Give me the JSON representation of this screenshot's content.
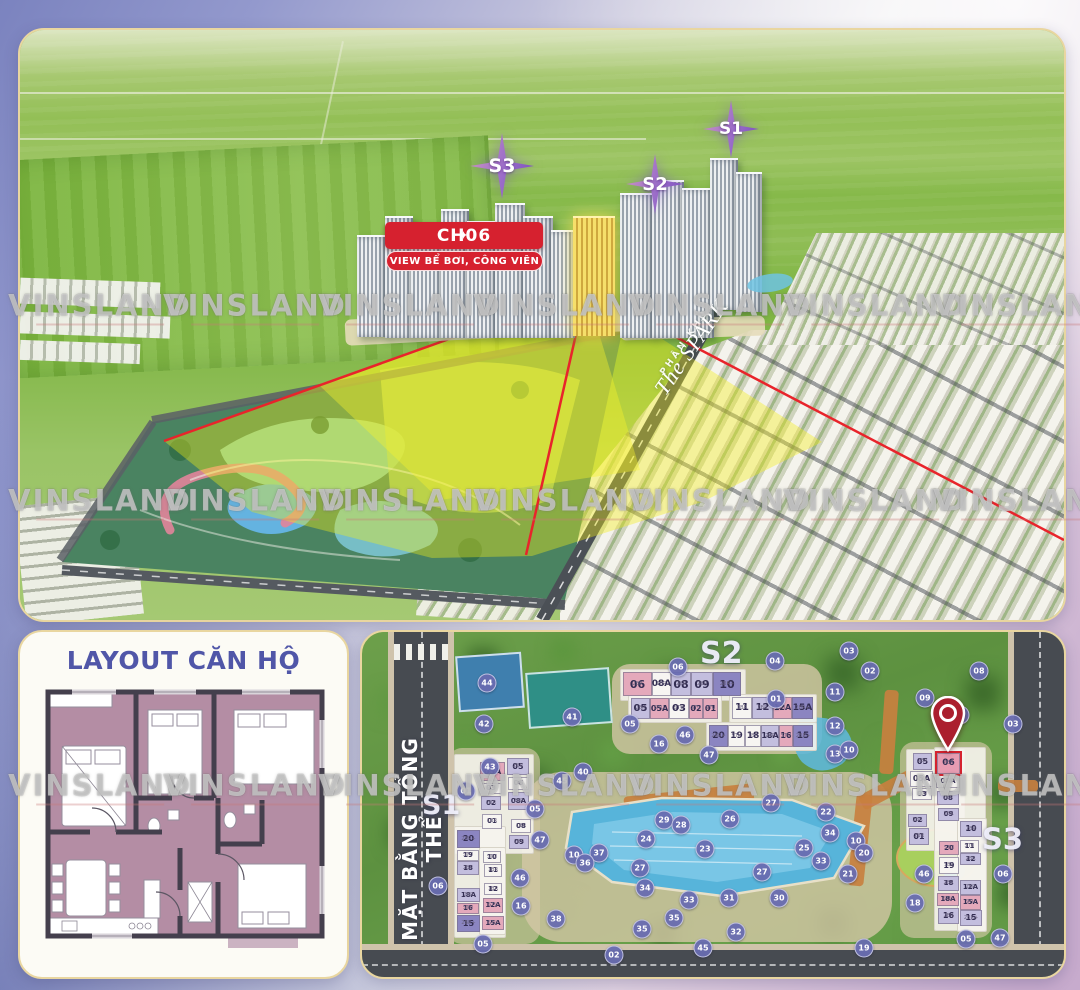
{
  "brand": {
    "watermark": "VINSLAND"
  },
  "colors": {
    "accent_red": "#d6212f",
    "star_purple": "#8e63c6",
    "marker_purple": "#686cb0",
    "tone_pink": "#e4a9bb",
    "tone_light": "#c3bede",
    "tone_dark": "#8b85c1",
    "gold_highlight": "#f6df6a"
  },
  "watermarks": [
    {
      "x": 100,
      "y": 307
    },
    {
      "x": 255,
      "y": 307
    },
    {
      "x": 410,
      "y": 307
    },
    {
      "x": 565,
      "y": 307
    },
    {
      "x": 720,
      "y": 307
    },
    {
      "x": 875,
      "y": 307
    },
    {
      "x": 1025,
      "y": 307
    },
    {
      "x": 100,
      "y": 502
    },
    {
      "x": 255,
      "y": 502
    },
    {
      "x": 410,
      "y": 502
    },
    {
      "x": 565,
      "y": 502
    },
    {
      "x": 720,
      "y": 502
    },
    {
      "x": 875,
      "y": 502
    },
    {
      "x": 1025,
      "y": 502
    },
    {
      "x": 100,
      "y": 787
    },
    {
      "x": 255,
      "y": 787
    },
    {
      "x": 410,
      "y": 787
    },
    {
      "x": 565,
      "y": 787
    },
    {
      "x": 720,
      "y": 787
    },
    {
      "x": 875,
      "y": 787
    },
    {
      "x": 1025,
      "y": 787
    }
  ],
  "aerial": {
    "badges": [
      {
        "label": "S3",
        "x": 450,
        "y": 103,
        "w": 64,
        "h": 66,
        "size": 19
      },
      {
        "label": "S2",
        "x": 606,
        "y": 124,
        "w": 58,
        "h": 60,
        "size": 18
      },
      {
        "label": "S1",
        "x": 683,
        "y": 70,
        "w": 56,
        "h": 58,
        "size": 17
      }
    ],
    "callout": {
      "sparkle": "✦",
      "title": "CH06",
      "subtitle": "VIEW BỂ BƠI, CÔNG VIÊN"
    },
    "zone": {
      "line1": "PHÂN KHU",
      "line2": "The SPARK"
    }
  },
  "floorplan": {
    "title": "LAYOUT CĂN HỘ"
  },
  "siteplan": {
    "side_label": "MẶT BẰNG TỔNG THỂ",
    "labels": [
      {
        "label": "S2",
        "x": 338,
        "y": 4,
        "size": 30
      },
      {
        "label": "S1",
        "x": 60,
        "y": 158,
        "size": 27
      },
      {
        "label": "S3",
        "x": 620,
        "y": 190,
        "size": 29
      }
    ],
    "highlight_unit": "06",
    "cells": [
      {
        "label": "06",
        "sub": "2BR",
        "tone": "pink",
        "x": 261,
        "y": 40,
        "w": 29,
        "h": 24,
        "size": 11
      },
      {
        "label": "08A",
        "sub": "1BR",
        "tone": "white",
        "x": 290,
        "y": 40,
        "w": 19,
        "h": 24,
        "size": 9
      },
      {
        "label": "08",
        "sub": "2BR",
        "tone": "light",
        "x": 309,
        "y": 40,
        "w": 20,
        "h": 24,
        "size": 11
      },
      {
        "label": "09",
        "sub": "2BR",
        "tone": "light",
        "x": 329,
        "y": 40,
        "w": 22,
        "h": 24,
        "size": 11
      },
      {
        "label": "10",
        "sub": "2BR+",
        "tone": "dark",
        "x": 351,
        "y": 40,
        "w": 28,
        "h": 24,
        "size": 11
      },
      {
        "label": "05",
        "sub": "2BR",
        "tone": "light",
        "x": 269,
        "y": 66,
        "w": 19,
        "h": 21,
        "size": 10
      },
      {
        "label": "05A",
        "sub": "STU",
        "tone": "pink",
        "x": 288,
        "y": 66,
        "w": 19,
        "h": 21,
        "size": 8
      },
      {
        "label": "03",
        "sub": "STU",
        "tone": "white",
        "x": 307,
        "y": 66,
        "w": 20,
        "h": 21,
        "size": 10
      },
      {
        "label": "02",
        "sub": "STU",
        "tone": "pink",
        "x": 327,
        "y": 66,
        "w": 14,
        "h": 21,
        "size": 8
      },
      {
        "label": "01",
        "sub": "STU",
        "tone": "pink",
        "x": 341,
        "y": 66,
        "w": 15,
        "h": 21,
        "size": 8
      },
      {
        "label": "11",
        "sub": "1BR",
        "tone": "white",
        "x": 370,
        "y": 65,
        "w": 20,
        "h": 22,
        "size": 10
      },
      {
        "label": "12",
        "sub": "2BR",
        "tone": "light",
        "x": 390,
        "y": 65,
        "w": 21,
        "h": 22,
        "size": 10
      },
      {
        "label": "12A",
        "sub": "STU",
        "tone": "pink",
        "x": 411,
        "y": 65,
        "w": 19,
        "h": 22,
        "size": 8
      },
      {
        "label": "15A",
        "sub": "2BR+",
        "tone": "dark",
        "x": 430,
        "y": 65,
        "w": 21,
        "h": 22,
        "size": 9
      },
      {
        "label": "20",
        "sub": "2BR+",
        "tone": "dark",
        "x": 347,
        "y": 93,
        "w": 19,
        "h": 22,
        "size": 9
      },
      {
        "label": "19",
        "sub": "STU",
        "tone": "white",
        "x": 366,
        "y": 93,
        "w": 17,
        "h": 22,
        "size": 9
      },
      {
        "label": "18",
        "sub": "1BR",
        "tone": "white",
        "x": 383,
        "y": 93,
        "w": 16,
        "h": 22,
        "size": 9
      },
      {
        "label": "18A",
        "sub": "2BR",
        "tone": "light",
        "x": 399,
        "y": 93,
        "w": 18,
        "h": 22,
        "size": 8
      },
      {
        "label": "16",
        "sub": "STU",
        "tone": "pink",
        "x": 417,
        "y": 93,
        "w": 14,
        "h": 22,
        "size": 8
      },
      {
        "label": "15",
        "sub": "2BR+",
        "tone": "dark",
        "x": 431,
        "y": 93,
        "w": 20,
        "h": 22,
        "size": 9
      },
      {
        "label": "05A",
        "sub": "STU",
        "tone": "pink",
        "x": 118,
        "y": 130,
        "w": 25,
        "h": 19,
        "size": 8
      },
      {
        "label": "03",
        "sub": "STU",
        "tone": "white",
        "x": 118,
        "y": 151,
        "w": 22,
        "h": 11,
        "size": 7
      },
      {
        "label": "02",
        "sub": "2BR",
        "tone": "light",
        "x": 119,
        "y": 164,
        "w": 20,
        "h": 14,
        "size": 7
      },
      {
        "label": "01",
        "sub": "1BR",
        "tone": "white",
        "x": 120,
        "y": 182,
        "w": 20,
        "h": 15,
        "size": 7
      },
      {
        "label": "05",
        "sub": "2BR",
        "tone": "light",
        "x": 145,
        "y": 126,
        "w": 22,
        "h": 17,
        "size": 8
      },
      {
        "label": "06",
        "sub": "1BR",
        "tone": "white",
        "x": 146,
        "y": 145,
        "w": 21,
        "h": 13,
        "size": 7
      },
      {
        "label": "08A",
        "sub": "2BR",
        "tone": "light",
        "x": 146,
        "y": 160,
        "w": 21,
        "h": 18,
        "size": 7
      },
      {
        "label": "08",
        "sub": "1BR",
        "tone": "white",
        "x": 149,
        "y": 187,
        "w": 20,
        "h": 14,
        "size": 7
      },
      {
        "label": "09",
        "sub": "2BR",
        "tone": "light",
        "x": 147,
        "y": 203,
        "w": 20,
        "h": 14,
        "size": 7
      },
      {
        "label": "20",
        "sub": "2BR+",
        "tone": "dark",
        "x": 95,
        "y": 198,
        "w": 23,
        "h": 18,
        "size": 8
      },
      {
        "label": "19",
        "sub": "STU",
        "tone": "white",
        "x": 95,
        "y": 218,
        "w": 22,
        "h": 11,
        "size": 7
      },
      {
        "label": "18",
        "sub": "2BR",
        "tone": "light",
        "x": 95,
        "y": 229,
        "w": 22,
        "h": 14,
        "size": 7
      },
      {
        "label": "18A",
        "sub": "2BR",
        "tone": "light",
        "x": 95,
        "y": 256,
        "w": 23,
        "h": 14,
        "size": 7
      },
      {
        "label": "16",
        "sub": "STU",
        "tone": "pink",
        "x": 95,
        "y": 271,
        "w": 22,
        "h": 11,
        "size": 7
      },
      {
        "label": "15",
        "sub": "2BR+",
        "tone": "dark",
        "x": 95,
        "y": 283,
        "w": 23,
        "h": 17,
        "size": 8
      },
      {
        "label": "10",
        "sub": "STU",
        "tone": "white",
        "x": 121,
        "y": 219,
        "w": 18,
        "h": 12,
        "size": 7
      },
      {
        "label": "11",
        "sub": "1BR",
        "tone": "white",
        "x": 122,
        "y": 232,
        "w": 18,
        "h": 13,
        "size": 7
      },
      {
        "label": "12",
        "sub": "1BR",
        "tone": "white",
        "x": 122,
        "y": 251,
        "w": 18,
        "h": 12,
        "size": 7
      },
      {
        "label": "12A",
        "sub": "STU",
        "tone": "pink",
        "x": 121,
        "y": 266,
        "w": 20,
        "h": 15,
        "size": 7
      },
      {
        "label": "15A",
        "sub": "STU",
        "tone": "pink",
        "x": 120,
        "y": 284,
        "w": 22,
        "h": 14,
        "size": 7
      },
      {
        "label": "05",
        "sub": "2BR",
        "tone": "light",
        "x": 551,
        "y": 121,
        "w": 19,
        "h": 17,
        "size": 8
      },
      {
        "label": "05A",
        "sub": "STU",
        "tone": "white",
        "x": 548,
        "y": 139,
        "w": 23,
        "h": 16,
        "size": 8
      },
      {
        "label": "03",
        "sub": "STU",
        "tone": "white",
        "x": 550,
        "y": 156,
        "w": 20,
        "h": 12,
        "size": 7
      },
      {
        "label": "02",
        "sub": "2BR",
        "tone": "light",
        "x": 546,
        "y": 182,
        "w": 19,
        "h": 13,
        "size": 7
      },
      {
        "label": "01",
        "sub": "2BR",
        "tone": "light",
        "x": 547,
        "y": 196,
        "w": 20,
        "h": 17,
        "size": 8
      },
      {
        "label": "06",
        "sub": "2BR",
        "tone": "pink",
        "x": 575,
        "y": 121,
        "w": 23,
        "h": 21,
        "size": 9,
        "highlight": true
      },
      {
        "label": "08A",
        "sub": "1BR",
        "tone": "white",
        "x": 574,
        "y": 143,
        "w": 24,
        "h": 13,
        "size": 7
      },
      {
        "label": "08",
        "sub": "2BR",
        "tone": "light",
        "x": 575,
        "y": 159,
        "w": 22,
        "h": 14,
        "size": 7
      },
      {
        "label": "09",
        "sub": "2BR",
        "tone": "light",
        "x": 576,
        "y": 176,
        "w": 21,
        "h": 13,
        "size": 7
      },
      {
        "label": "10",
        "sub": "2BR",
        "tone": "light",
        "x": 598,
        "y": 189,
        "w": 22,
        "h": 16,
        "size": 8
      },
      {
        "label": "20",
        "sub": "STU",
        "tone": "pink",
        "x": 577,
        "y": 209,
        "w": 20,
        "h": 14,
        "size": 7
      },
      {
        "label": "11",
        "sub": "STU",
        "tone": "white",
        "x": 598,
        "y": 208,
        "w": 19,
        "h": 13,
        "size": 7
      },
      {
        "label": "12",
        "sub": "2BR",
        "tone": "light",
        "x": 598,
        "y": 221,
        "w": 21,
        "h": 12,
        "size": 7
      },
      {
        "label": "19",
        "sub": "1BR",
        "tone": "white",
        "x": 577,
        "y": 225,
        "w": 20,
        "h": 17,
        "size": 8
      },
      {
        "label": "18",
        "sub": "2BR",
        "tone": "light",
        "x": 576,
        "y": 244,
        "w": 21,
        "h": 15,
        "size": 7
      },
      {
        "label": "12A",
        "sub": "2BR",
        "tone": "light",
        "x": 598,
        "y": 248,
        "w": 21,
        "h": 15,
        "size": 7
      },
      {
        "label": "18A",
        "sub": "STU",
        "tone": "pink",
        "x": 575,
        "y": 261,
        "w": 22,
        "h": 13,
        "size": 7
      },
      {
        "label": "15A",
        "sub": "STU",
        "tone": "pink",
        "x": 598,
        "y": 263,
        "w": 21,
        "h": 15,
        "size": 7
      },
      {
        "label": "16",
        "sub": "2BR",
        "tone": "light",
        "x": 576,
        "y": 276,
        "w": 21,
        "h": 16,
        "size": 8
      },
      {
        "label": "15",
        "sub": "2BR+",
        "tone": "light",
        "x": 598,
        "y": 278,
        "w": 22,
        "h": 16,
        "size": 8
      }
    ],
    "markers": [
      {
        "n": "44",
        "x": 125,
        "y": 51
      },
      {
        "n": "42",
        "x": 122,
        "y": 92
      },
      {
        "n": "41",
        "x": 210,
        "y": 85
      },
      {
        "n": "43",
        "x": 128,
        "y": 135
      },
      {
        "n": "45",
        "x": 200,
        "y": 149
      },
      {
        "n": "06",
        "x": 316,
        "y": 35
      },
      {
        "n": "04",
        "x": 413,
        "y": 29
      },
      {
        "n": "03",
        "x": 487,
        "y": 19
      },
      {
        "n": "02",
        "x": 508,
        "y": 39
      },
      {
        "n": "01",
        "x": 414,
        "y": 67
      },
      {
        "n": "11",
        "x": 473,
        "y": 60
      },
      {
        "n": "08",
        "x": 617,
        "y": 39
      },
      {
        "n": "07",
        "x": 598,
        "y": 83
      },
      {
        "n": "09",
        "x": 563,
        "y": 66
      },
      {
        "n": "03",
        "x": 651,
        "y": 92
      },
      {
        "n": "12",
        "x": 473,
        "y": 94
      },
      {
        "n": "13",
        "x": 473,
        "y": 122
      },
      {
        "n": "10",
        "x": 487,
        "y": 118
      },
      {
        "n": "05",
        "x": 268,
        "y": 92
      },
      {
        "n": "16",
        "x": 297,
        "y": 112
      },
      {
        "n": "46",
        "x": 323,
        "y": 103
      },
      {
        "n": "47",
        "x": 347,
        "y": 123
      },
      {
        "n": "01",
        "x": 104,
        "y": 159
      },
      {
        "n": "40",
        "x": 221,
        "y": 140
      },
      {
        "n": "05",
        "x": 173,
        "y": 177
      },
      {
        "n": "47",
        "x": 178,
        "y": 208
      },
      {
        "n": "46",
        "x": 158,
        "y": 246
      },
      {
        "n": "16",
        "x": 159,
        "y": 274
      },
      {
        "n": "06",
        "x": 76,
        "y": 254
      },
      {
        "n": "05",
        "x": 121,
        "y": 312
      },
      {
        "n": "27",
        "x": 409,
        "y": 171
      },
      {
        "n": "22",
        "x": 464,
        "y": 180
      },
      {
        "n": "29",
        "x": 302,
        "y": 188
      },
      {
        "n": "28",
        "x": 319,
        "y": 193
      },
      {
        "n": "26",
        "x": 368,
        "y": 187
      },
      {
        "n": "34",
        "x": 468,
        "y": 201
      },
      {
        "n": "24",
        "x": 284,
        "y": 207
      },
      {
        "n": "23",
        "x": 343,
        "y": 217
      },
      {
        "n": "25",
        "x": 442,
        "y": 216
      },
      {
        "n": "10",
        "x": 494,
        "y": 209
      },
      {
        "n": "20",
        "x": 502,
        "y": 221
      },
      {
        "n": "37",
        "x": 237,
        "y": 221
      },
      {
        "n": "10",
        "x": 212,
        "y": 223
      },
      {
        "n": "36",
        "x": 223,
        "y": 231
      },
      {
        "n": "27",
        "x": 278,
        "y": 236
      },
      {
        "n": "33",
        "x": 459,
        "y": 229
      },
      {
        "n": "21",
        "x": 486,
        "y": 242
      },
      {
        "n": "27",
        "x": 400,
        "y": 240
      },
      {
        "n": "34",
        "x": 283,
        "y": 256
      },
      {
        "n": "33",
        "x": 327,
        "y": 268
      },
      {
        "n": "31",
        "x": 367,
        "y": 266
      },
      {
        "n": "30",
        "x": 417,
        "y": 266
      },
      {
        "n": "35",
        "x": 312,
        "y": 286
      },
      {
        "n": "35",
        "x": 280,
        "y": 297
      },
      {
        "n": "38",
        "x": 194,
        "y": 287
      },
      {
        "n": "32",
        "x": 374,
        "y": 300
      },
      {
        "n": "45",
        "x": 341,
        "y": 316
      },
      {
        "n": "02",
        "x": 252,
        "y": 323
      },
      {
        "n": "19",
        "x": 502,
        "y": 316
      },
      {
        "n": "06",
        "x": 641,
        "y": 242
      },
      {
        "n": "46",
        "x": 562,
        "y": 242
      },
      {
        "n": "18",
        "x": 553,
        "y": 271
      },
      {
        "n": "05",
        "x": 604,
        "y": 307
      },
      {
        "n": "47",
        "x": 638,
        "y": 306
      }
    ]
  }
}
